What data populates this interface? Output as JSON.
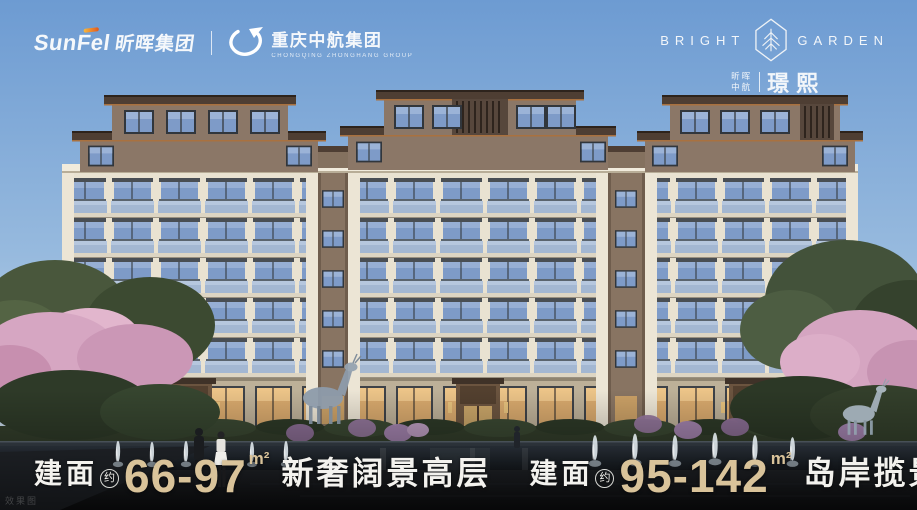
{
  "header": {
    "sunfel": {
      "latin": "SunFel",
      "cn": "昕晖集团"
    },
    "zhonghang": {
      "cn": "重庆中航集团",
      "en": "CHONGQING ZHONGHANG GROUP"
    },
    "brand": {
      "word_left": "BRIGHT",
      "word_right": "GARDEN",
      "sub_line1": "昕晖",
      "sub_line2": "中航",
      "name": "璟熙"
    }
  },
  "footer": {
    "items": [
      {
        "prefix": "建面",
        "approx": "约",
        "range": "66-97",
        "unit": "m²",
        "tagline": "新奢阔景高层"
      },
      {
        "prefix": "建面",
        "approx": "约",
        "range": "95-142",
        "unit": "m²",
        "tagline": "岛岸揽景洋房"
      }
    ]
  },
  "watermark": "效果图",
  "colors": {
    "gold": "#d9c39a",
    "sky_top": "#6d9bd2",
    "sky_bottom": "#d8e4f0",
    "facade": "#e9e2d1",
    "penthouse": "#8b7767"
  }
}
